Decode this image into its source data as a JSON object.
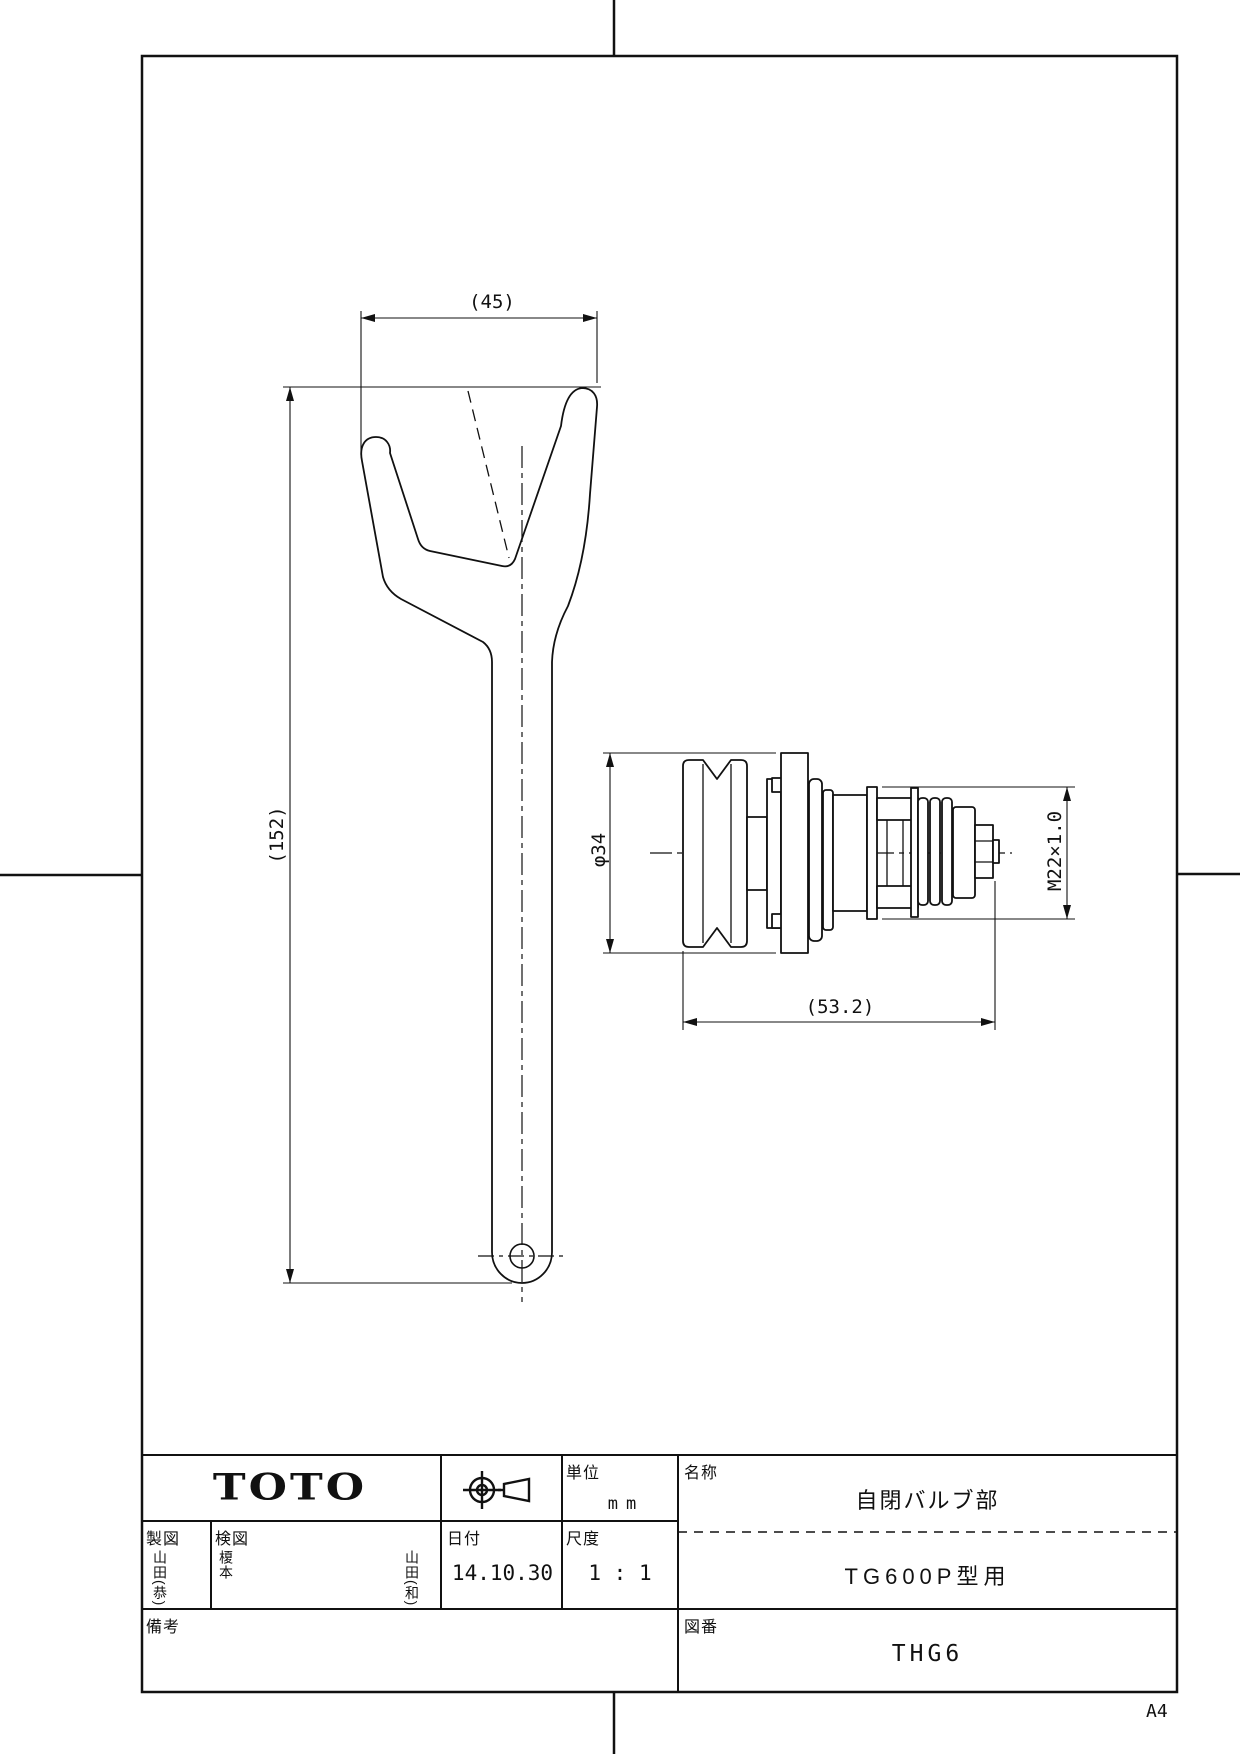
{
  "sheet": {
    "size": "A4"
  },
  "dim": {
    "wrench_width": "(45)",
    "wrench_length": "(152)",
    "valve_dia": "φ34",
    "thread": "M22×1.0",
    "valve_length": "(53.2)"
  },
  "tb": {
    "logo": "TOTO",
    "unit_label": "単位",
    "unit_value": "mm",
    "drafter_label": "製図",
    "drafter_name": "山田(恭)",
    "checker_label": "検図",
    "checker_name": "榎本",
    "approver_name": "山田(和)",
    "date_label": "日付",
    "date_value": "14.10.30",
    "scale_label": "尺度",
    "scale_value": "1 : 1",
    "name_label": "名称",
    "part_name": "自閉バルブ部",
    "model": "TG600P型用",
    "remarks_label": "備考",
    "dwg_no_label": "図番",
    "dwg_no": "THG6"
  }
}
